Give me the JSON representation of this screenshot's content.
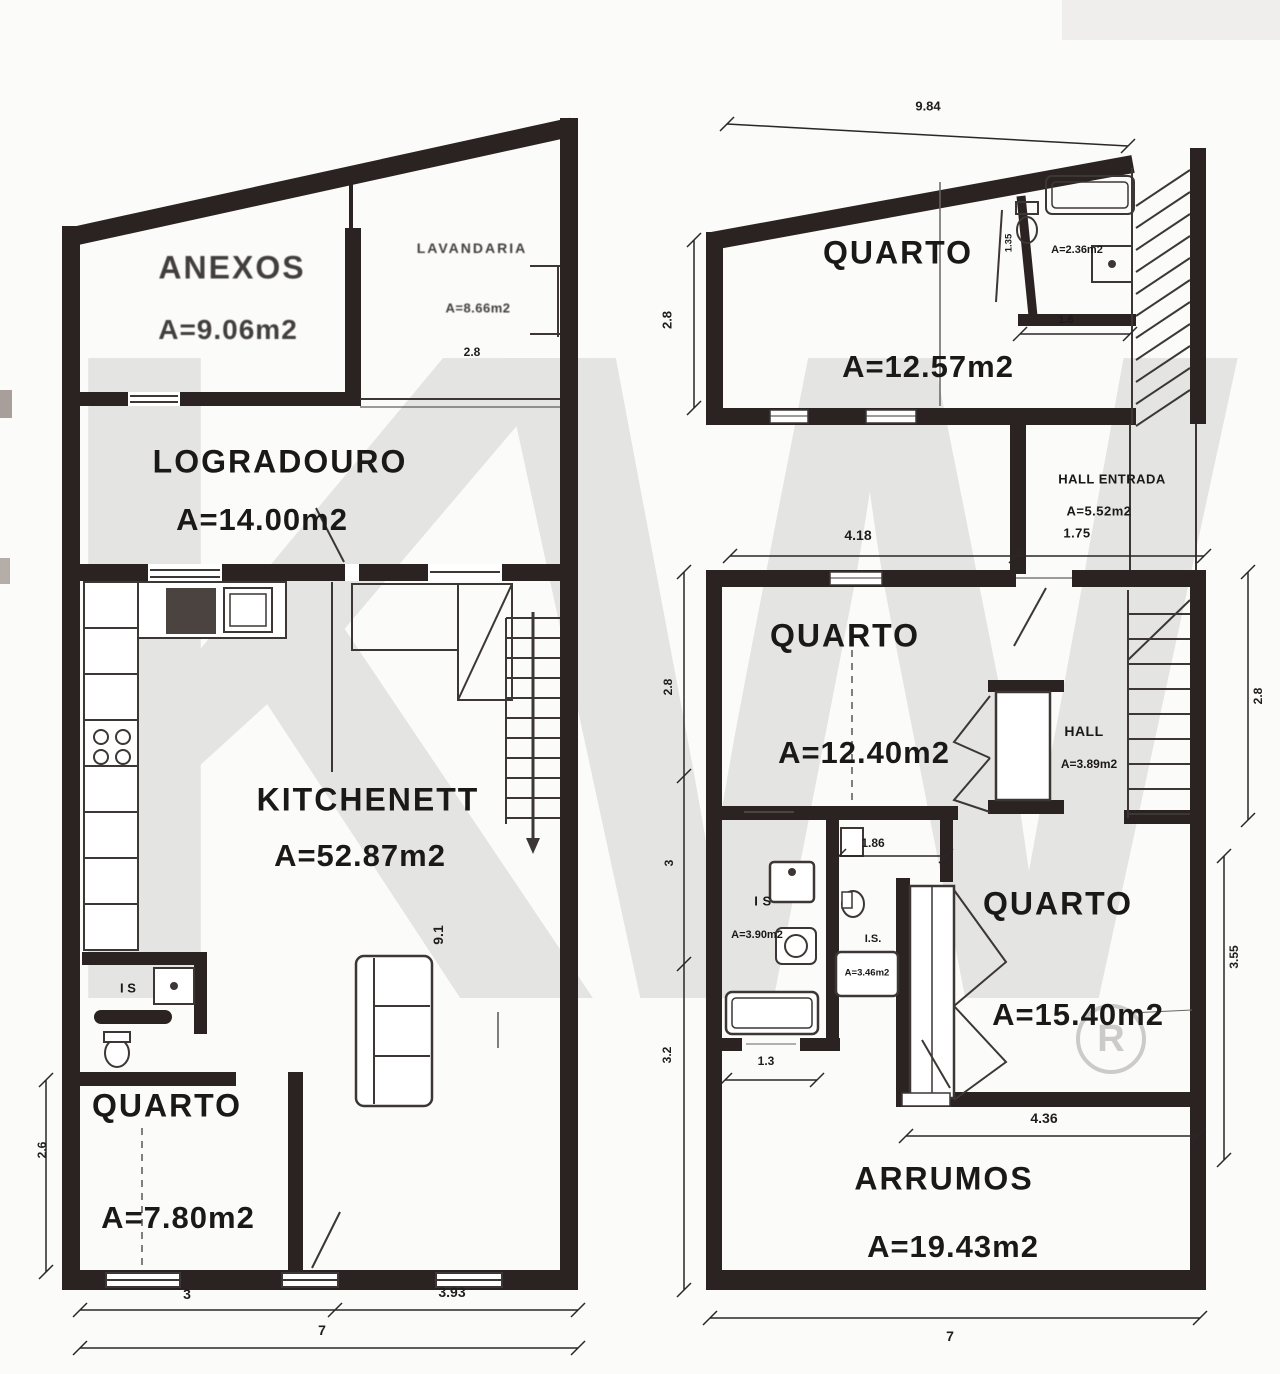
{
  "watermark": {
    "text": "KW",
    "registered": "R"
  },
  "left_plan": {
    "anexos_label": "ANEXOS",
    "anexos_area": "A=9.06m2",
    "lavandaria_label": "LAVANDARIA",
    "lavandaria_area": "A=8.66m2",
    "lavandaria_dim": "2.8",
    "logradouro_label": "LOGRADOURO",
    "logradouro_area": "A=14.00m2",
    "kitchenett_label": "KITCHENETT",
    "kitchenett_area": "A=52.87m2",
    "is_label": "I S",
    "quarto_label": "QUARTO",
    "quarto_area": "A=7.80m2",
    "dim_quarto_width": "3",
    "dim_kitchen_width": "3.93",
    "dim_total_width": "7",
    "dim_quarto_height": "2.6",
    "dim_kitchen_height": "9.1"
  },
  "upper_plan": {
    "dim_top": "9.84",
    "dim_left": "2.8",
    "quarto_label": "QUARTO",
    "quarto_area": "A=12.57m2",
    "is_area": "A=2.36m2",
    "is_dim_width": "1.6",
    "is_dim_height": "1.35"
  },
  "hall_entrada": {
    "label": "HALL ENTRADA",
    "area": "A=5.52m2",
    "dim": "1.75"
  },
  "lower_plan": {
    "dim_top_left": "4.18",
    "quarto1_label": "QUARTO",
    "quarto1_area": "A=12.40m2",
    "hall_label": "HALL",
    "hall_area": "A=3.89m2",
    "is1_label": "I S",
    "is1_area": "A=3.90m2",
    "is2_label": "I.S.",
    "is2_area": "A=3.46m2",
    "is2_dim": "1.86",
    "quarto2_label": "QUARTO",
    "quarto2_area": "A=15.40m2",
    "arrumos_label": "ARRUMOS",
    "arrumos_area": "A=19.43m2",
    "dim_left_top": "2.8",
    "dim_left_mid": "3",
    "dim_left_bottom": "3.2",
    "dim_is_width": "1.3",
    "dim_quarto2_width": "4.36",
    "dim_bottom": "7",
    "dim_right_top": "2.8",
    "dim_right_mid": "3.55"
  }
}
